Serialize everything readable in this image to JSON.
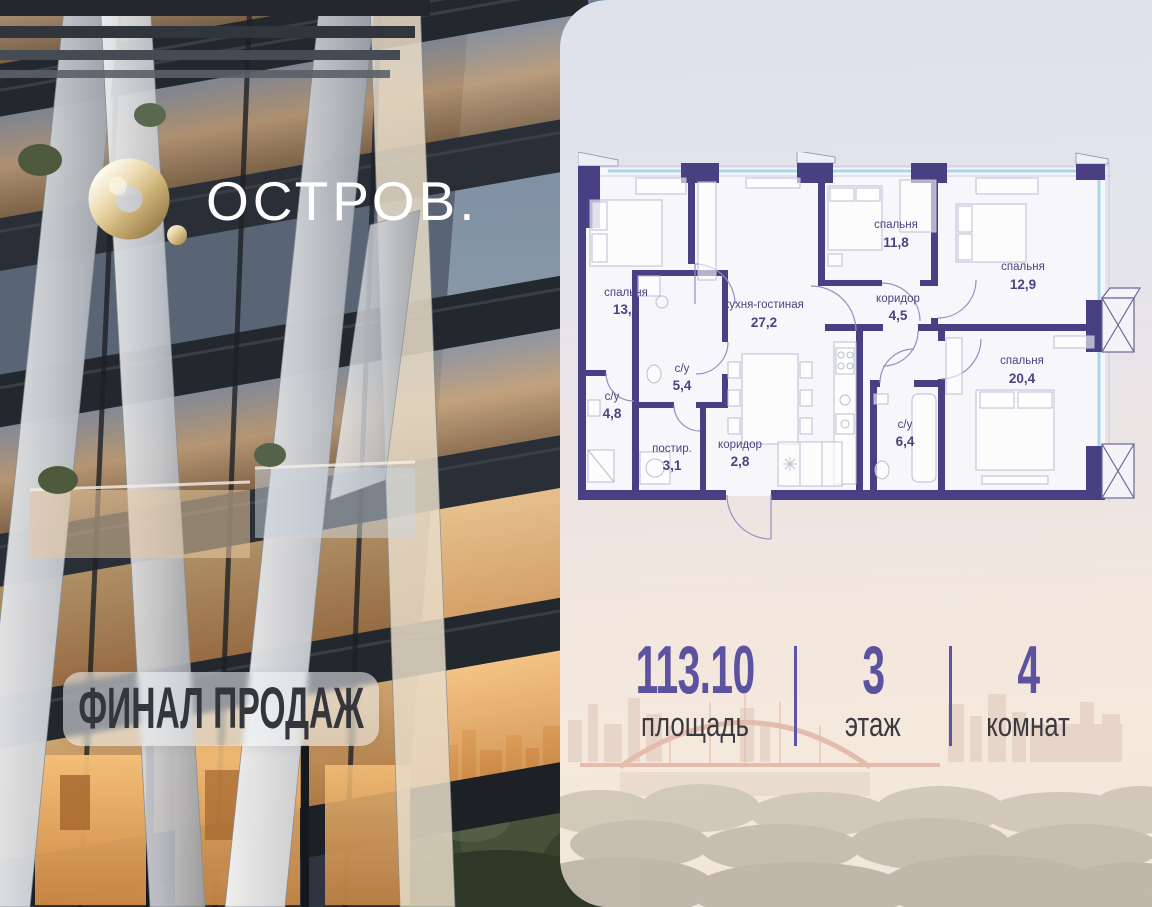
{
  "brand": {
    "logo_text": "ОСТРОВ.",
    "logo_icon": "ring-and-dot-logo-icon"
  },
  "badge": {
    "label": "ФИНАЛ ПРОДАЖ"
  },
  "floorplan": {
    "rooms": [
      {
        "name": "спальня",
        "area": "13,8"
      },
      {
        "name": "кухня-гостиная",
        "area": "27,2"
      },
      {
        "name": "спальня",
        "area": "11,8"
      },
      {
        "name": "коридор",
        "area": "4,5"
      },
      {
        "name": "спальня",
        "area": "12,9"
      },
      {
        "name": "с/у",
        "area": "5,4"
      },
      {
        "name": "с/у",
        "area": "4,8"
      },
      {
        "name": "постир.",
        "area": "3,1"
      },
      {
        "name": "коридор",
        "area": "2,8"
      },
      {
        "name": "с/у",
        "area": "6,4"
      },
      {
        "name": "спальня",
        "area": "20,4"
      }
    ]
  },
  "stats": [
    {
      "value": "113.10",
      "label": "площадь"
    },
    {
      "value": "3",
      "label": "этаж"
    },
    {
      "value": "4",
      "label": "комнат"
    }
  ],
  "colors": {
    "wall": "#494083",
    "glazing": "#a9d6ea",
    "accent_purple": "#5b53a0",
    "brand_gold": "#d9c394",
    "badge_text": "#35363c"
  }
}
